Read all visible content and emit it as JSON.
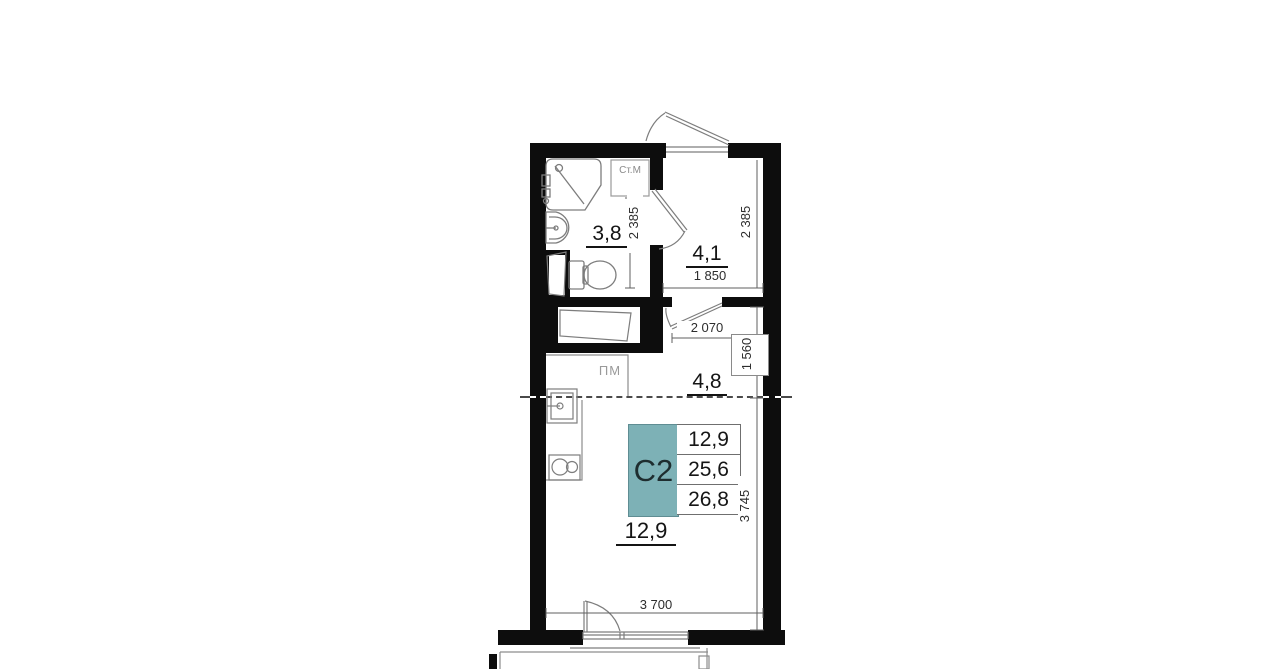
{
  "plan": {
    "unit_code": "С2",
    "accent_color": "#7db1b6",
    "rooms": [
      {
        "name": "bathroom",
        "area": "3,8"
      },
      {
        "name": "hallway",
        "area": "4,1"
      },
      {
        "name": "kitchen-niche",
        "area": "4,8"
      },
      {
        "name": "living-room",
        "area": "12,9"
      }
    ],
    "info_table": {
      "code": "С2",
      "values": [
        "12,9",
        "25,6",
        "26,8"
      ]
    },
    "appliance_labels": {
      "washing_machine": "Ст.М",
      "dishwasher_place": "ПМ"
    },
    "dimensions": {
      "bathroom_depth": "2 385",
      "hallway_depth": "2 385",
      "hallway_width": "1 850",
      "kitchen_opening_width": "2 070",
      "kitchen_niche_depth": "1 560",
      "living_room_depth": "3 745",
      "living_room_width": "3 700"
    }
  }
}
